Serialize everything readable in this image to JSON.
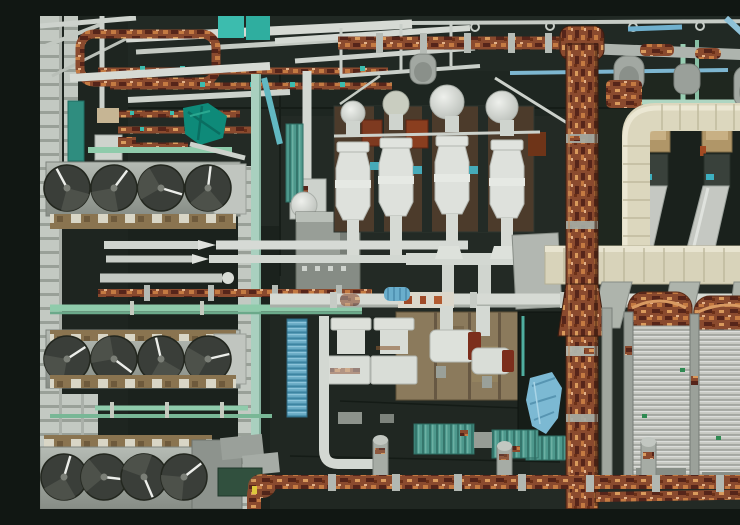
{
  "meta": {
    "title": "Industrial rooftop aerial photograph",
    "description": "Top-down aerial photograph of a dense industrial plant rooftop: three banks of four axial cooling fans on the left, white silencer stacks on rust-brown pads top-center, a heavily corroded vertical pipe on the right, cream-colored ducting, finned cooler units bottom-right, mint-green and sky-blue service pipes, teal tarpaulin and junction boxes, all over a dark bitumen roof.",
    "visible_text": []
  },
  "palette": {
    "roof": "#232a25",
    "roof-dark": "#1a211c",
    "rust": "#8a4a2e",
    "rust-dark": "#56251a",
    "rust-orange": "#c47a42",
    "pipe-white": "#d6dad4",
    "steel-gray": "#9ba19a",
    "cream": "#dcd7be",
    "mint": "#8fcbab",
    "teal": "#2f8d7f",
    "cyan": "#3cbcae",
    "sky-blue": "#7db6d0",
    "tarp-blue": "#7cb9d3",
    "fin-gray": "#c6c8c1",
    "tan": "#8a7450",
    "fan-dark": "#3a3e39"
  },
  "scene": {
    "regions": [
      {
        "name": "left-scaffold",
        "description": "White lattice scaffolding and ladder rails along the left edge"
      },
      {
        "name": "fan-bank-top",
        "description": "Row of four dark axial fans in a gray housing with tan terminal strip"
      },
      {
        "name": "fan-bank-middle",
        "description": "Second row of four fans with mint-green supply pipe above"
      },
      {
        "name": "fan-bank-bottom",
        "description": "Third row of four fans at the bottom edge"
      },
      {
        "name": "top-pipe-network",
        "description": "Dense band of white, rusted and sky-blue pipes along the top edge"
      },
      {
        "name": "teal-tarp",
        "description": "Teal tarpaulin wrapped over equipment, upper left"
      },
      {
        "name": "silencer-units",
        "description": "Four white vertical silencer stacks with domed tops on rust-brown pads"
      },
      {
        "name": "overhead-rust-pipe",
        "description": "Segmented corroded pipe running along the top toward the main riser"
      },
      {
        "name": "lance-pipes",
        "description": "Horizontal white pipes with conical tips across the middle band"
      },
      {
        "name": "main-white-pipe",
        "description": "Long horizontal white pipe crossing the center"
      },
      {
        "name": "ahu-cluster",
        "description": "Small white air-handling units and canisters on a tan pad, center"
      },
      {
        "name": "blue-corrugated-panel",
        "description": "Blue corrugated panel on the center-left wall strip"
      },
      {
        "name": "blue-tarp",
        "description": "Light-blue striped tarpaulin, center right"
      },
      {
        "name": "teal-junction-boxes",
        "description": "Teal ribbed junction boxes on the lower roof"
      },
      {
        "name": "bottom-rust-pipe",
        "description": "Heavily rusted horizontal pipe run with gray collars along the bottom"
      },
      {
        "name": "cream-duct-header",
        "description": "Cream rectangular duct header frame and band, upper right"
      },
      {
        "name": "inclined-ducts",
        "description": "Three gray inclined ducts with brass junction boxes inside the cream frame"
      },
      {
        "name": "rust-main-riser",
        "description": "Large heavily corroded vertical pipe running the full height on the right"
      },
      {
        "name": "finned-cooler-units",
        "description": "Finned cooler units with rusted U-bend caps, bottom right"
      }
    ]
  }
}
